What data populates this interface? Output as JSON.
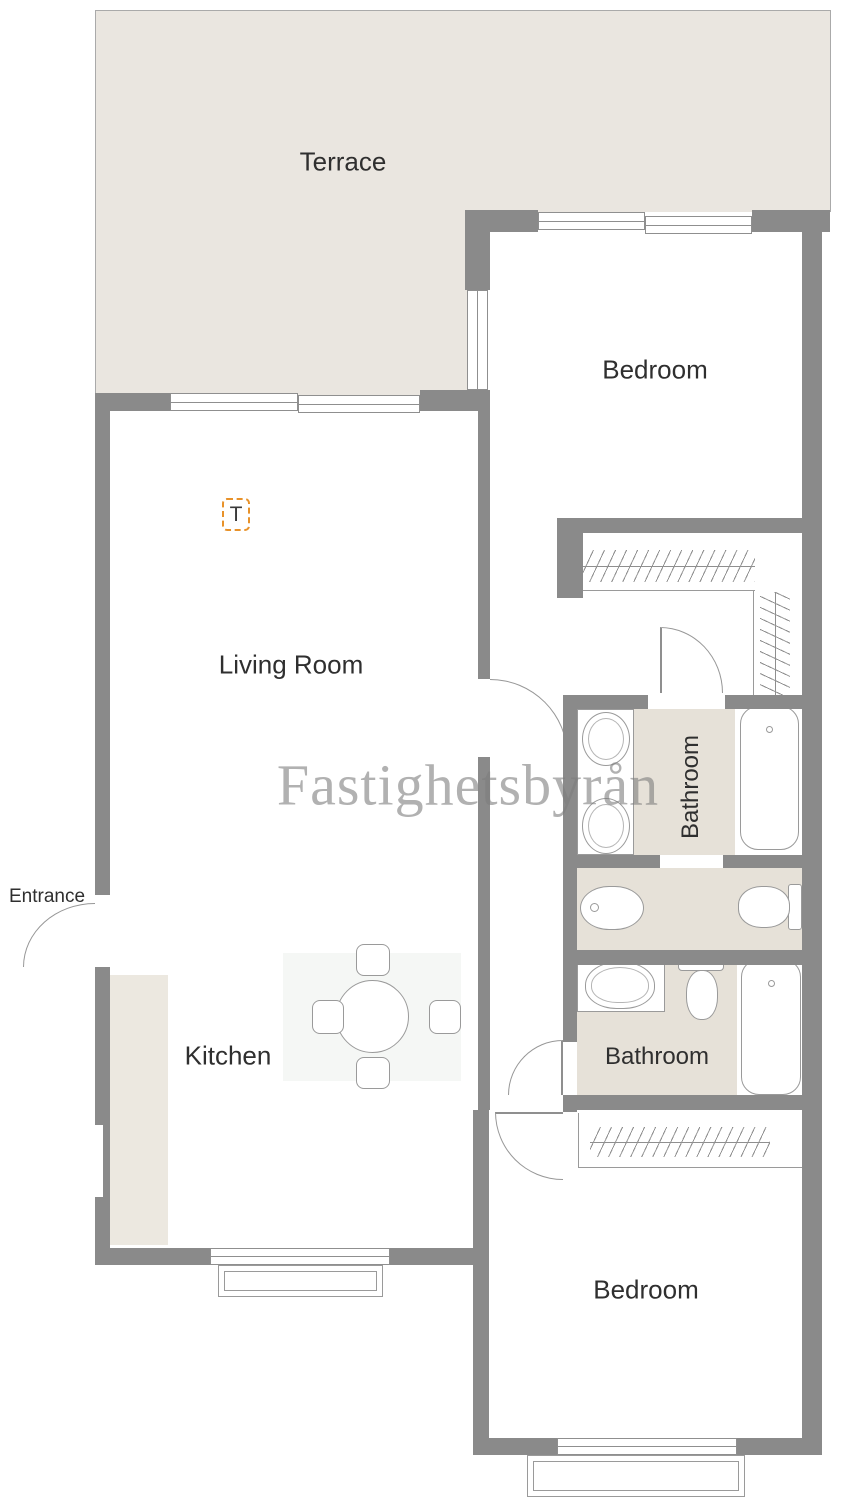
{
  "plan": {
    "watermark": "Fastighetsbyrån",
    "rooms": {
      "terrace": "Terrace",
      "bedroom_top": "Bedroom",
      "living_room": "Living Room",
      "bathroom_top": "Bathroom",
      "bathroom_bottom": "Bathroom",
      "kitchen": "Kitchen",
      "entrance": "Entrance",
      "bedroom_bottom": "Bedroom"
    },
    "markers": {
      "t_marker": "T"
    },
    "colors": {
      "wall_gray": "#8a8a8a",
      "terrace_floor": "#eae6e0",
      "bathroom_floor": "#e6e1d8",
      "kitchen_counter": "#ece8e0",
      "marker_orange": "#e8922a",
      "label_text": "#2f2f2f",
      "watermark_gray": "#7d7d7d"
    }
  }
}
